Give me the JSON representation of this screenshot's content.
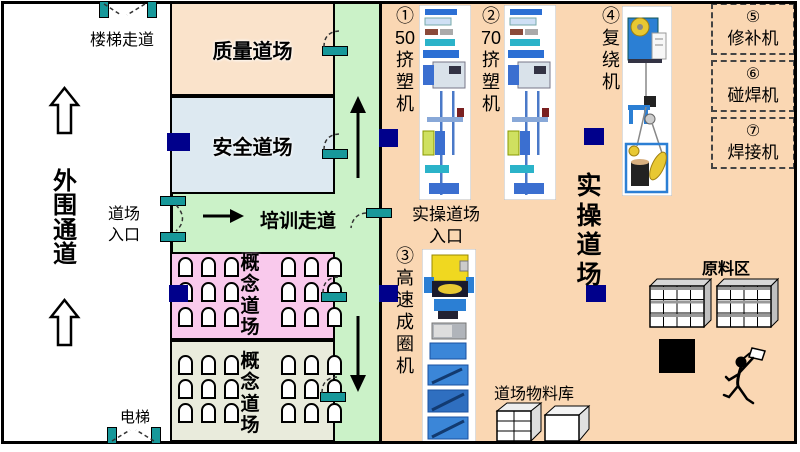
{
  "colors": {
    "wall_black": "#000000",
    "corridor_green": "#cbf2c8",
    "quality_peach": "#fae3cb",
    "safety_blue": "#dde9f1",
    "concept_pink": "#f9c9ec",
    "concept_gray": "#e9ebdc",
    "practical_orange": "#fad7b3",
    "door_teal": "#17989a",
    "marker_navy": "#00008b"
  },
  "left_zone": {
    "stair_walkway": "楼梯走道",
    "outer_corridor": "外围通道",
    "dojo_entrance": "道场入口",
    "elevator": "电梯"
  },
  "rooms": {
    "quality": "质量道场",
    "safety": "安全道场",
    "training_walkway": "培训走道",
    "concept_upper": "概念道场",
    "concept_lower": "概念道场",
    "practical": "实操道场",
    "practical_entrance_line1": "实操道场",
    "practical_entrance_line2": "入口"
  },
  "machines": {
    "extruder_50": "①50挤塑机",
    "extruder_70": "②70挤塑机",
    "high_speed_coiler": "③高速成圈机",
    "rewinder": "④复绕机",
    "repair": {
      "num": "⑤",
      "name": "修补机"
    },
    "spot_welder": {
      "num": "⑥",
      "name": "碰焊机"
    },
    "welder": {
      "num": "⑦",
      "name": "焊接机"
    }
  },
  "storage": {
    "material_store": "道场物料库",
    "raw_material_area": "原料区"
  }
}
